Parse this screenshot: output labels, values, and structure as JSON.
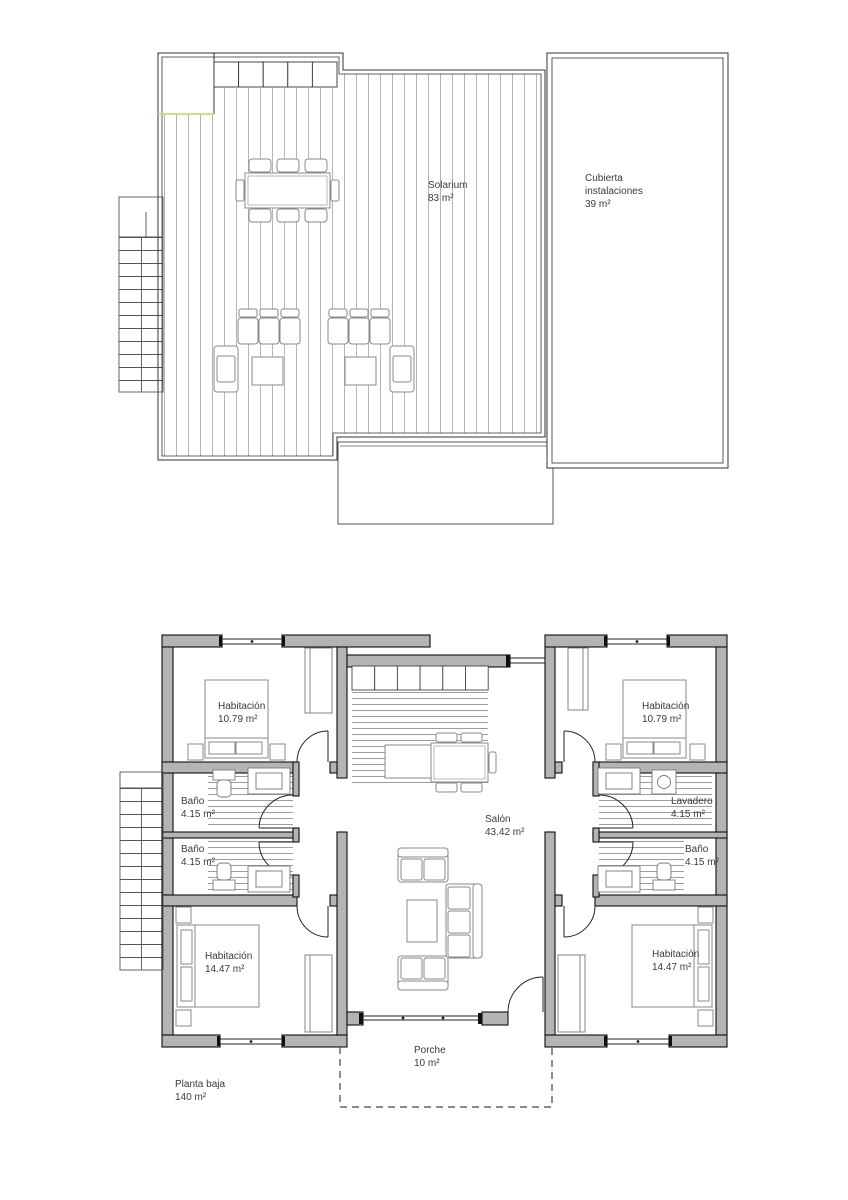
{
  "upper": {
    "solarium": {
      "name": "Solarium",
      "area": "83 m²"
    },
    "cubierta": {
      "line1": "Cubierta",
      "line2": "instalaciones",
      "area": "39 m²"
    }
  },
  "ground": {
    "title": {
      "name": "Planta baja",
      "area": "140 m²"
    },
    "bedroom_tl": {
      "name": "Habitación",
      "area": "10.79 m²"
    },
    "bedroom_tr": {
      "name": "Habitación",
      "area": "10.79 m²"
    },
    "bath_l1": {
      "name": "Baño",
      "area": "4.15 m²"
    },
    "bath_l2": {
      "name": "Baño",
      "area": "4.15 m²"
    },
    "laundry": {
      "name": "Lavadero",
      "area": "4.15 m²"
    },
    "bath_r": {
      "name": "Baño",
      "area": "4.15 m²"
    },
    "bedroom_bl": {
      "name": "Habitación",
      "area": "14.47 m²"
    },
    "bedroom_br": {
      "name": "Habitación",
      "area": "14.47 m²"
    },
    "living": {
      "name": "Salón",
      "area": "43.42 m²"
    },
    "porch": {
      "name": "Porche",
      "area": "10 m²"
    }
  }
}
